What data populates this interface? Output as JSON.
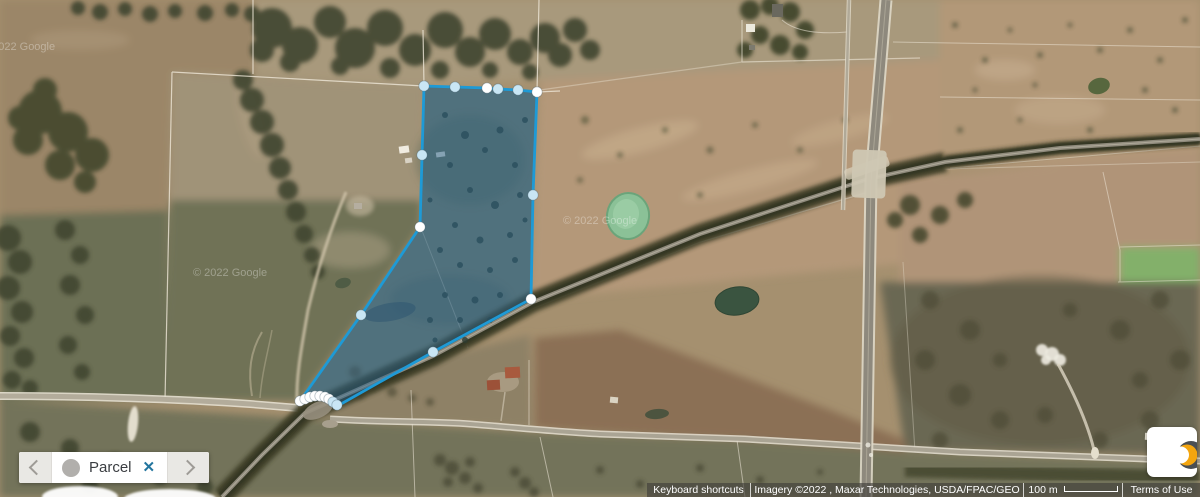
{
  "legend_bar": {
    "label": "Parcel",
    "close_glyph": "✕"
  },
  "attribution": {
    "keyboard_shortcuts": "Keyboard shortcuts",
    "imagery": "Imagery ©2022 , Maxar Technologies, USDA/FPAC/GEO",
    "scale_label": "100 m",
    "terms": "Terms of Use"
  },
  "watermarks": [
    {
      "text": "©2022 Google",
      "x": -16,
      "y": 50
    },
    {
      "text": "© 2022 Google",
      "x": 193,
      "y": 276
    },
    {
      "text": "© 2022 Google",
      "x": 563,
      "y": 224
    }
  ],
  "parcel": {
    "stroke_color": "#1e9ad6",
    "fill_color": "rgba(40,100,145,0.48)",
    "handle_colors": {
      "white": "#ffffff",
      "blue": "#c9e6f4"
    },
    "outline": [
      [
        424,
        86
      ],
      [
        455,
        87
      ],
      [
        487,
        88
      ],
      [
        498,
        89
      ],
      [
        518,
        90
      ],
      [
        537,
        92
      ],
      [
        533,
        195
      ],
      [
        531,
        299
      ],
      [
        433,
        352
      ],
      [
        341,
        404
      ],
      [
        333,
        402
      ],
      [
        325,
        397
      ],
      [
        315,
        396
      ],
      [
        305,
        399
      ],
      [
        300,
        401
      ],
      [
        361,
        315
      ],
      [
        420,
        227
      ]
    ],
    "handles": [
      {
        "x": 424,
        "y": 86,
        "c": "blue"
      },
      {
        "x": 455,
        "y": 87,
        "c": "blue"
      },
      {
        "x": 487,
        "y": 88,
        "c": "white"
      },
      {
        "x": 498,
        "y": 89,
        "c": "blue"
      },
      {
        "x": 518,
        "y": 90,
        "c": "blue"
      },
      {
        "x": 537,
        "y": 92,
        "c": "white"
      },
      {
        "x": 422,
        "y": 155,
        "c": "blue"
      },
      {
        "x": 533,
        "y": 195,
        "c": "blue"
      },
      {
        "x": 531,
        "y": 299,
        "c": "white"
      },
      {
        "x": 433,
        "y": 352,
        "c": "blue"
      },
      {
        "x": 420,
        "y": 227,
        "c": "white"
      },
      {
        "x": 361,
        "y": 315,
        "c": "blue"
      },
      {
        "x": 300,
        "y": 401,
        "c": "white"
      },
      {
        "x": 305,
        "y": 399,
        "c": "white"
      },
      {
        "x": 310,
        "y": 397,
        "c": "white"
      },
      {
        "x": 315,
        "y": 396,
        "c": "white"
      },
      {
        "x": 320,
        "y": 396,
        "c": "white"
      },
      {
        "x": 325,
        "y": 397,
        "c": "white"
      },
      {
        "x": 329,
        "y": 399,
        "c": "white"
      },
      {
        "x": 333,
        "y": 402,
        "c": "blue"
      },
      {
        "x": 337,
        "y": 405,
        "c": "blue"
      }
    ]
  }
}
